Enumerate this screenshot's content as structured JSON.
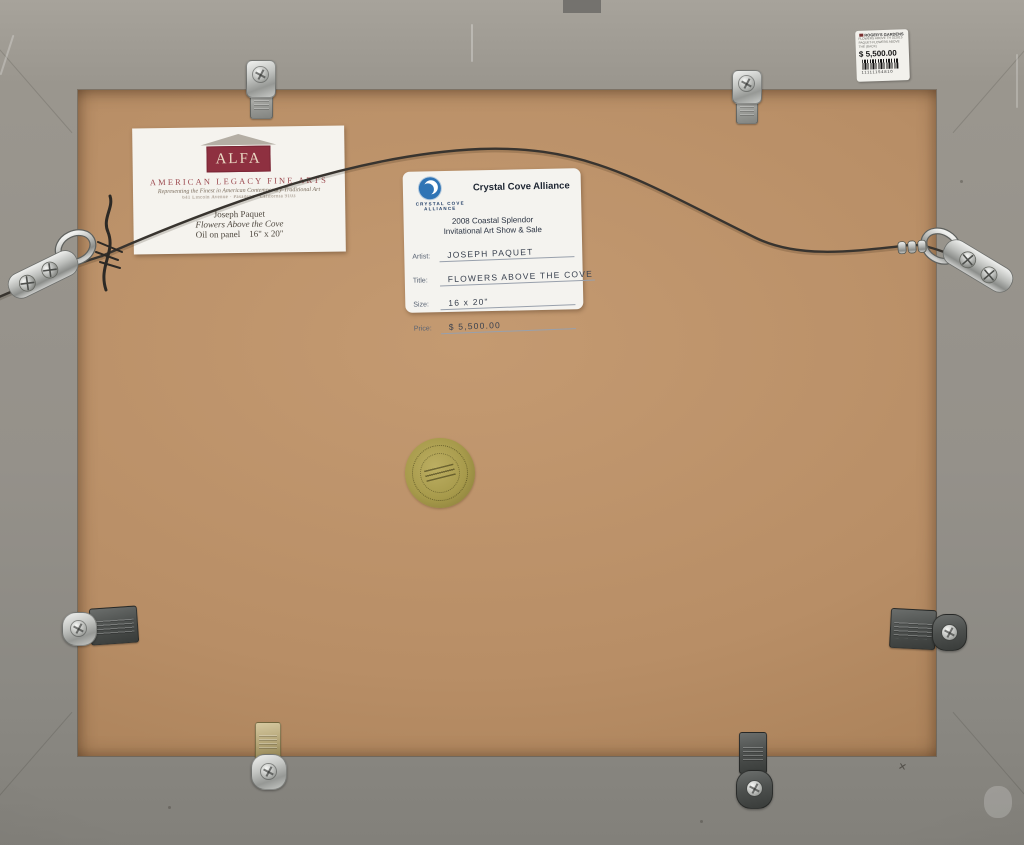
{
  "alfa_label": {
    "logo_text": "ALFA",
    "gallery_name": "AMERICAN LEGACY FINE ARTS",
    "tagline": "Representing the Finest in American Contemporary-Traditional Art",
    "address": "641 Lincoln Avenue  ·  Pasadena  ·  California 9103",
    "artist": "Joseph Paquet",
    "title": "Flowers Above the Cove",
    "medium_size": "Oil on panel    16\" x 20\""
  },
  "cca_label": {
    "logo_line1": "CRYSTAL COVE",
    "logo_line2": "ALLIANCE",
    "org_name": "Crystal Cove Alliance",
    "event_line1": "2008 Coastal Splendor",
    "event_line2": "Invitational Art Show & Sale",
    "fields": [
      {
        "label": "Artist:",
        "value": "JOSEPH PAQUET"
      },
      {
        "label": "Title:",
        "value": "FLOWERS ABOVE THE COVE"
      },
      {
        "label": "Size:",
        "value": "16 x 20\""
      },
      {
        "label": "Price:",
        "value": "$ 5,500.00"
      }
    ]
  },
  "price_sticker": {
    "store": "ROGER'S GARDENS",
    "line1": "FLOWERS ABOVE TH 022815",
    "line2": "PAQUET-FLOWERS ABOVE",
    "line3": "THE (BACK)",
    "price": "$ 5,500.00",
    "barcode_number": "11111154810"
  },
  "colors": {
    "frame_gray": "#95918a",
    "board_brown": "#b88e66",
    "alfa_maroon": "#8e3040",
    "cca_blue": "#2f74b5",
    "seal_gold": "#a79a4b"
  }
}
